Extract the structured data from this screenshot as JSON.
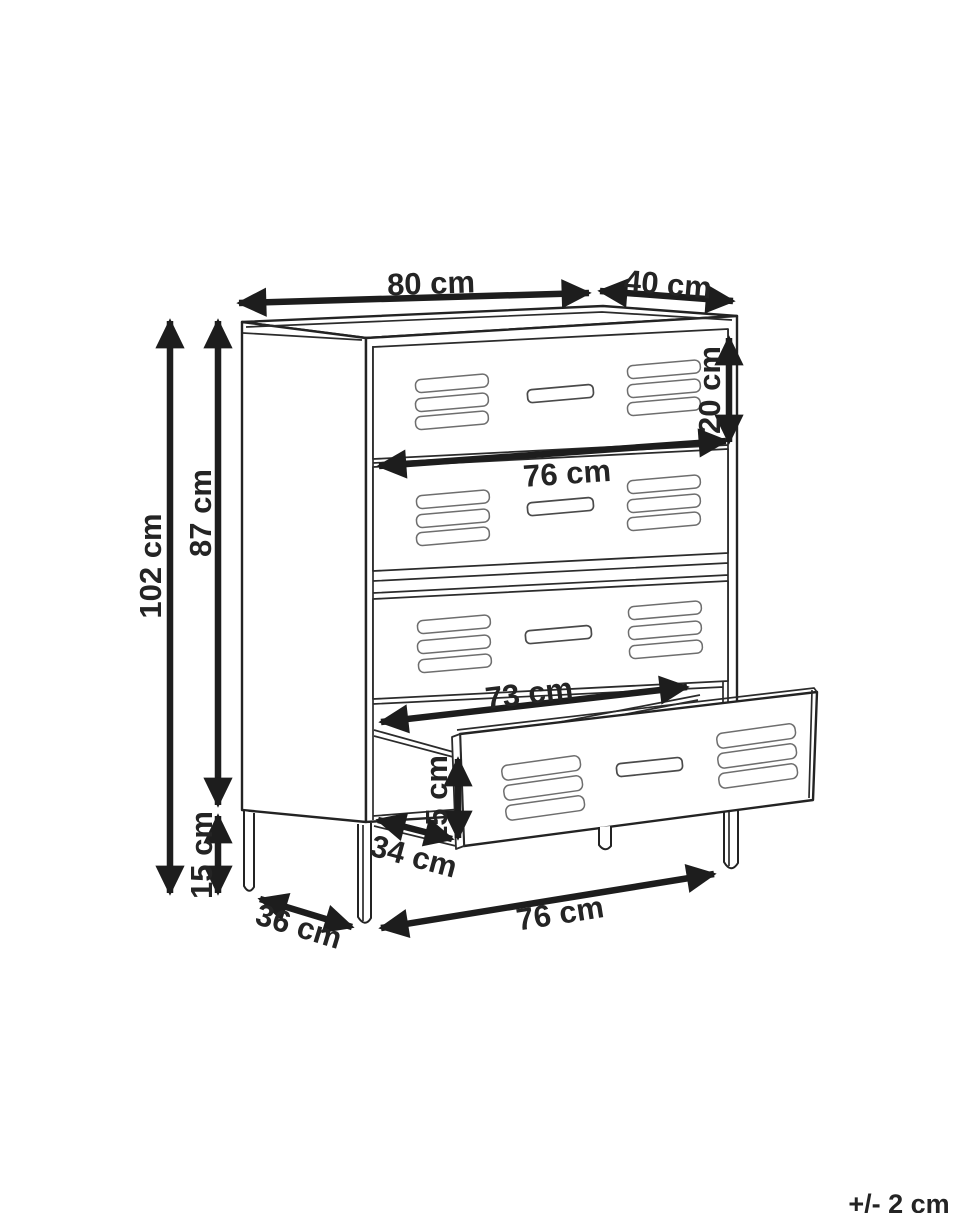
{
  "diagram": {
    "kind": "furniture-dimension-drawing",
    "tolerance": "+/- 2 cm",
    "dimensions": {
      "top_width": "80 cm",
      "top_depth": "40 cm",
      "total_height": "102 cm",
      "body_height": "87 cm",
      "leg_height": "15 cm",
      "top_drawer_height": "20 cm",
      "inner_width": "76 cm",
      "opening_width": "73 cm",
      "drawer_front_height": "15 cm",
      "pullout_depth": "34 cm",
      "base_depth": "36 cm",
      "front_leg_span": "76 cm"
    },
    "colors": {
      "background": "#ffffff",
      "line": "#232323",
      "dimension_arrow": "#1d1d1d",
      "label_text": "#242424",
      "vent_outline": "#6e6e6e"
    }
  }
}
